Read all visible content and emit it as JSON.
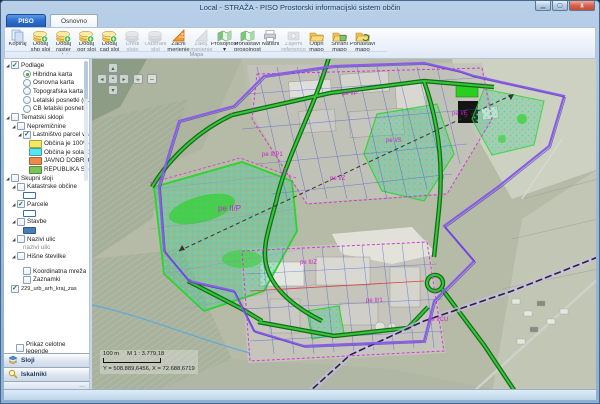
{
  "window": {
    "title": "Local - STRAŽA - PISO Prostorski informacijski sistem občin",
    "close_glyph": "x"
  },
  "ribbon": {
    "app_tab": "PISO",
    "tabs": [
      "Osnovno"
    ],
    "group_label": "Mapa",
    "buttons": [
      {
        "label": "Kopiraj",
        "icon": "copy-icon",
        "enabled": true
      },
      {
        "label": "Dodaj shp sloj",
        "icon": "add-shp-layer-icon",
        "enabled": true
      },
      {
        "label": "Dodaj raster sloj",
        "icon": "add-raster-layer-icon",
        "enabled": true
      },
      {
        "label": "Dodaj ogr sloj",
        "icon": "add-ogr-layer-icon",
        "enabled": true
      },
      {
        "label": "Dodaj cad sloj",
        "icon": "add-cad-layer-icon",
        "enabled": true
      },
      {
        "label": "Uredi sloje",
        "icon": "edit-layers-icon",
        "enabled": false
      },
      {
        "label": "Odstrani sloj",
        "icon": "remove-layer-icon",
        "enabled": false
      },
      {
        "label": "Začni merjenje",
        "icon": "start-measure-icon",
        "enabled": true
      },
      {
        "label": "Zaklj. merjenje",
        "icon": "end-measure-icon",
        "enabled": false
      },
      {
        "label": "Prosojnost",
        "icon": "transparency-icon",
        "enabled": true,
        "dropdown": true
      },
      {
        "label": "Ponastavi prosojnost",
        "icon": "reset-transparency-icon",
        "enabled": true
      },
      {
        "label": "Natisni",
        "icon": "print-icon",
        "enabled": true
      },
      {
        "label": "Zajemi referenco",
        "icon": "capture-reference-icon",
        "enabled": false
      },
      {
        "label": "Odpri mapo",
        "icon": "open-map-icon",
        "enabled": true
      },
      {
        "label": "Shrani mapo",
        "icon": "save-map-icon",
        "enabled": true
      },
      {
        "label": "Ponastavi mapo",
        "icon": "reset-map-icon",
        "enabled": true
      }
    ]
  },
  "sidebar": {
    "tree": [
      {
        "t": "check",
        "ind": 0,
        "exp": true,
        "on": true,
        "label": "Podlage"
      },
      {
        "t": "radio",
        "ind": 2,
        "on": true,
        "label": "Hibridna karta"
      },
      {
        "t": "radio",
        "ind": 2,
        "on": false,
        "label": "Osnovna karta"
      },
      {
        "t": "radio",
        "ind": 2,
        "on": false,
        "label": "Topografska karta"
      },
      {
        "t": "radio",
        "ind": 2,
        "on": false,
        "label": "Letalski posnetki (gurs)"
      },
      {
        "t": "radio",
        "ind": 2,
        "on": false,
        "label": "ČB letalski posnetki (gurs-arhi)"
      },
      {
        "t": "check",
        "ind": 0,
        "exp": true,
        "on": false,
        "label": "Tematski sklopi"
      },
      {
        "t": "check",
        "ind": 1,
        "exp": true,
        "on": false,
        "label": "Nepremičnine"
      },
      {
        "t": "check",
        "ind": 2,
        "exp": true,
        "on": true,
        "label": "Lastništvo parcel v javni las"
      },
      {
        "t": "swatch",
        "ind": 3,
        "color": "#f2e95c",
        "label": "Občina je 100% lastnik"
      },
      {
        "t": "swatch",
        "ind": 3,
        "color": "#57e6ee",
        "label": "Občina je solastnik"
      },
      {
        "t": "swatch",
        "ind": 3,
        "color": "#ee8a4b",
        "label": "JAVNO DOBRO, SPLOŠN"
      },
      {
        "t": "swatch",
        "ind": 3,
        "color": "#79c35a",
        "label": "REPUBLIKA SLOVENIJA"
      },
      {
        "t": "check",
        "ind": 0,
        "exp": true,
        "on": false,
        "label": "Skupni sloji"
      },
      {
        "t": "check",
        "ind": 1,
        "exp": true,
        "on": false,
        "label": "Katastrske občine"
      },
      {
        "t": "symbol",
        "ind": 2,
        "sym": "outline"
      },
      {
        "t": "check",
        "ind": 1,
        "exp": true,
        "on": true,
        "label": "Parcele"
      },
      {
        "t": "symbol",
        "ind": 2,
        "sym": "outline"
      },
      {
        "t": "check",
        "ind": 1,
        "exp": true,
        "on": false,
        "label": "Stavbe"
      },
      {
        "t": "symbol",
        "ind": 2,
        "sym": "filled"
      },
      {
        "t": "check",
        "ind": 1,
        "exp": true,
        "on": false,
        "label": "Nazivi ulic"
      },
      {
        "t": "text",
        "ind": 2,
        "label": "nazivi ulic",
        "gray": true
      },
      {
        "t": "check",
        "ind": 1,
        "exp": true,
        "on": false,
        "label": "Hišne številke"
      },
      {
        "t": "gap"
      },
      {
        "t": "check",
        "ind": 2,
        "on": false,
        "label": "Koordinatna mreža"
      },
      {
        "t": "check",
        "ind": 2,
        "on": false,
        "label": "Zaznamki"
      },
      {
        "t": "check",
        "ind": 0,
        "on": true,
        "label": "229_urb_arh_kraj_zas",
        "small": true
      }
    ],
    "legend_toggle": "Prikaz celotne legende",
    "panels": [
      {
        "label": "Sloji",
        "icon": "layers-icon"
      },
      {
        "label": "Iskalniki",
        "icon": "search-icon"
      }
    ],
    "panel_overflow": "…"
  },
  "map": {
    "scalebar_label": "100 m",
    "scale_text": "M 1 : 3.779,18",
    "coordinates": "Y = 508.889,6456, X = 72.688,6719",
    "nav": {
      "up": "▴",
      "down": "▾",
      "left": "◂",
      "right": "▸",
      "center": "▪",
      "zoom_in": "+",
      "zoom_out": "−"
    },
    "zone_labels": [
      {
        "text": "pe II/P",
        "x": 126,
        "y": 152,
        "s": 8
      },
      {
        "text": "pe II/P1",
        "x": 170,
        "y": 97,
        "s": 6
      },
      {
        "text": "pe I/Z",
        "x": 238,
        "y": 121,
        "s": 6
      },
      {
        "text": "pe I/S",
        "x": 294,
        "y": 83,
        "s": 6
      },
      {
        "text": "pe I/P",
        "x": 250,
        "y": 36,
        "s": 6
      },
      {
        "text": "pe I/E",
        "x": 360,
        "y": 56,
        "s": 6
      },
      {
        "text": "pe II/1",
        "x": 274,
        "y": 243,
        "s": 6
      },
      {
        "text": "pe I/CU",
        "x": 336,
        "y": 262,
        "s": 6
      },
      {
        "text": "pe II/Z",
        "x": 208,
        "y": 205,
        "s": 6
      }
    ]
  },
  "colors": {
    "zone_label": "#cc22cc",
    "boundary_purple": "#8a5ce8",
    "road_green": "#35c73a",
    "parcel_blue": "#3b4fd8",
    "app_accent": "#2f6fce"
  }
}
